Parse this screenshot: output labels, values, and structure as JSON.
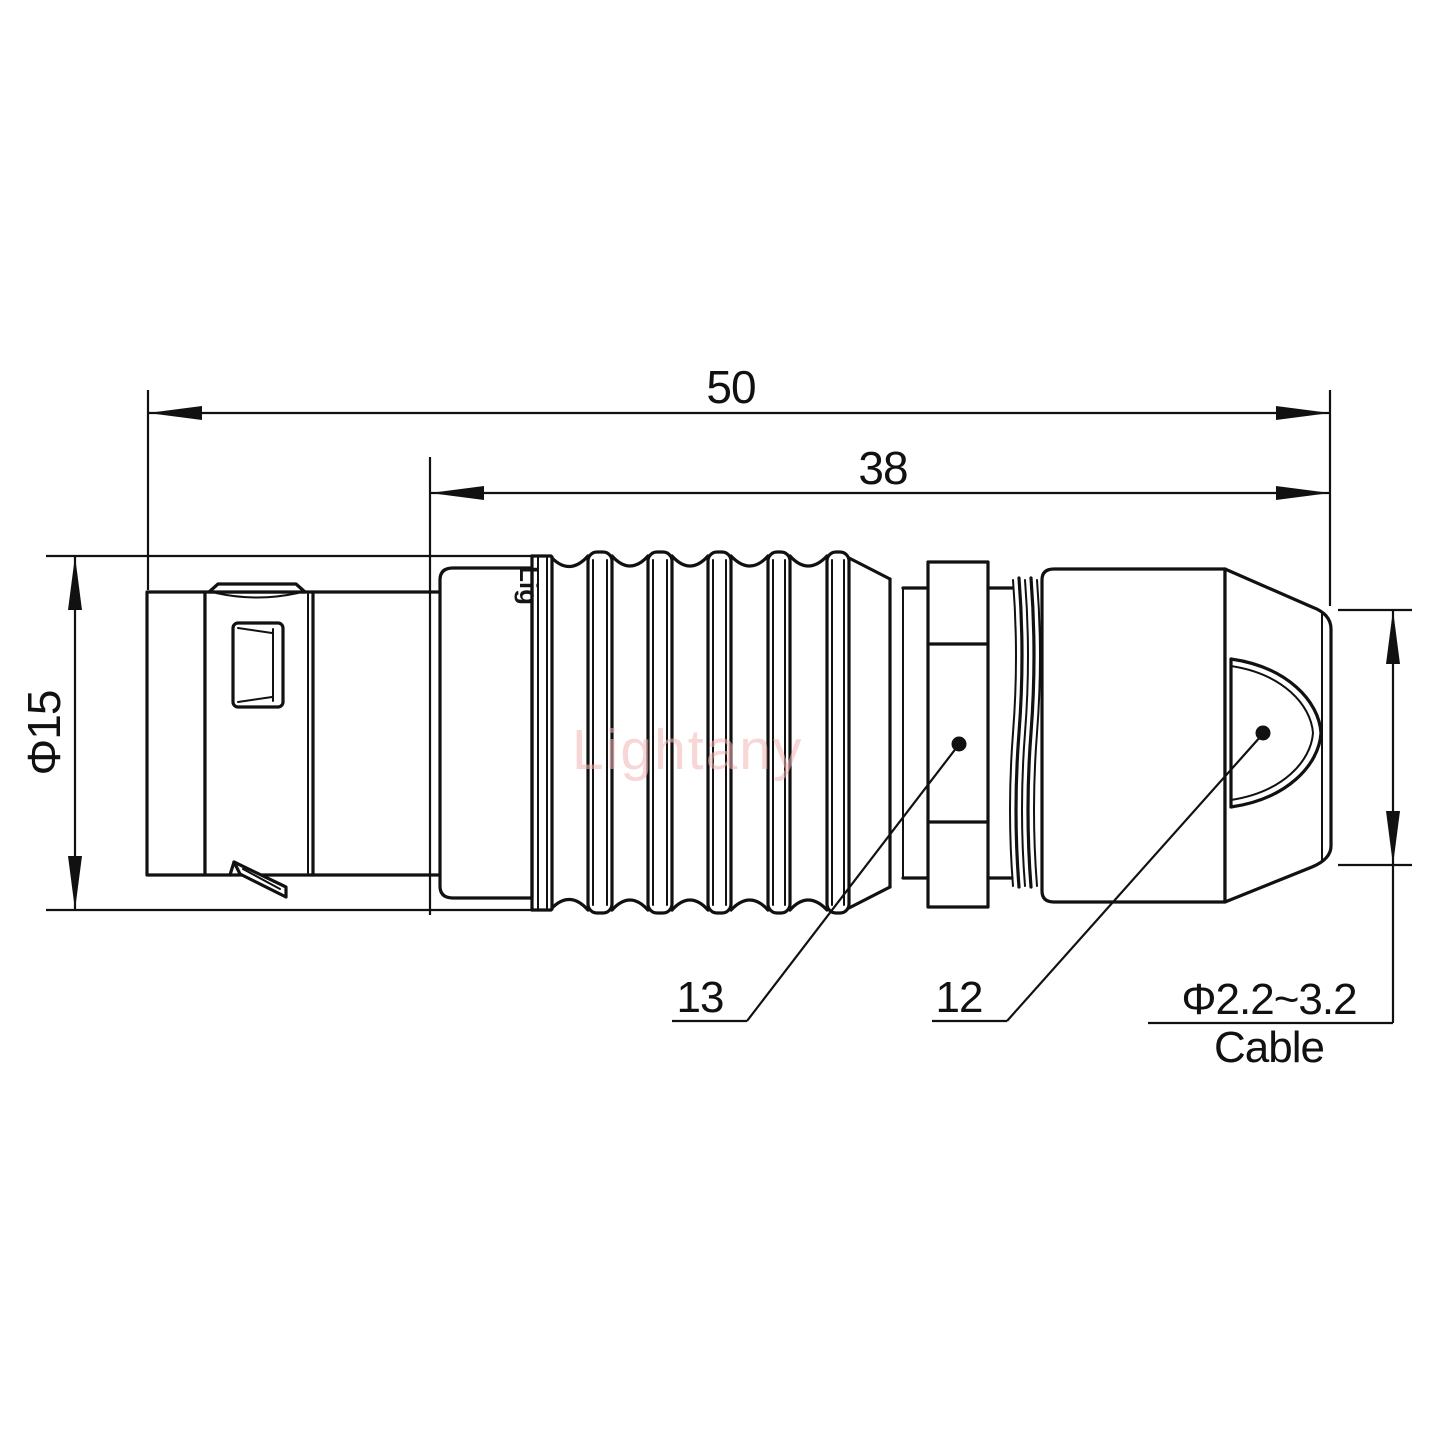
{
  "drawing": {
    "type": "connector-technical-drawing",
    "watermark": "Lightany",
    "engraving": "Lig",
    "dimensions": {
      "overall_length": {
        "value": "50"
      },
      "boot_length": {
        "value": "38"
      },
      "shell_diameter": {
        "value": "Φ15"
      },
      "cable_diameter": {
        "value": "Φ2.2~3.2",
        "label": "Cable"
      }
    },
    "part_labels": {
      "collar": "13",
      "back_nut": "12"
    },
    "colors": {
      "line": "#111111",
      "watermark": "#f3b6b6",
      "background": "#ffffff"
    }
  }
}
